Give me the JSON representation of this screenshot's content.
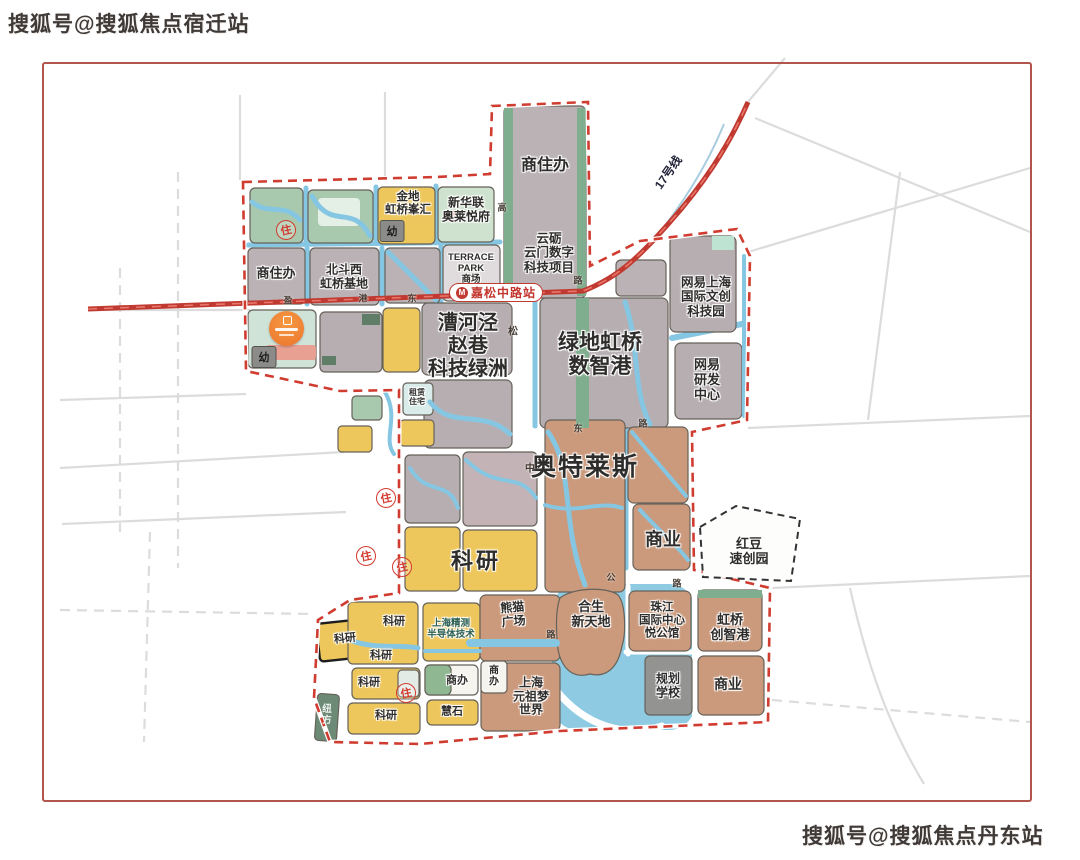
{
  "watermarks": {
    "top_left": "搜狐号@搜狐焦点宿迁站",
    "bottom_right": "搜狐号@搜狐焦点丹东站"
  },
  "metro": {
    "line_name": "17号线",
    "station_name": "嘉松中路站",
    "logo_letter": "M"
  },
  "stamps": {
    "residential": "住",
    "kindergarten": "幼"
  },
  "road_chars": {
    "c1": "盈",
    "c2": "港",
    "c3": "东",
    "c4": "路",
    "c5": "高",
    "c6": "松",
    "c7": "中",
    "c8": "东",
    "c9": "路",
    "c10": "公",
    "c11": "路",
    "c12": "路"
  },
  "colors": {
    "boundary_red": "#d03c30",
    "metro_red": "#c03a31",
    "water_blue": "#85c6e2",
    "parcel_grey": "#b7aeb2",
    "parcel_yellow": "#eec75c",
    "parcel_brown": "#cb9a7c"
  },
  "parcels": {
    "shangzhuban_north": "商住办",
    "yunli": "云砺\n云门数字\n科技项目",
    "jindi": "金地\n虹桥峯汇",
    "xinhualian": "新华联\n奥莱悦府",
    "shangzhuban_west": "商住办",
    "beidou": "北斗西\n虹桥基地",
    "terrace": "TERRACE\nPARK\n商场",
    "wangyi_park": "网易上海\n国际文创\n科技园",
    "wangyi_rd": "网易\n研发\n中心",
    "caohejing": "漕河泾\n赵巷\n科技绿洲",
    "lvdi": "绿地虹桥\n数智港",
    "zulin": "租赁\n住宅",
    "aotelaisi": "奥特莱斯",
    "shangye_east": "商业",
    "hongdou": "红豆\n速创园",
    "keyan_big": "科研",
    "keyan_1": "科研",
    "keyan_2": "科研",
    "keyan_3": "科研",
    "keyan_4": "科研",
    "keyan_5": "科研",
    "niufang": "纽\n方",
    "jingce": "上海精测\n半导体技术",
    "shangban_mid": "商办",
    "huishi": "慧石",
    "panda": "熊猫\n广场",
    "shangban_south": "商\n办",
    "yuanzu": "上海\n元祖梦\n世界",
    "hesheng": "合生\n新天地",
    "zhujiang": "珠江\n国际中心\n悦公馆",
    "hongqiao_czg": "虹桥\n创智港",
    "guihua": "规划\n学校",
    "shangye_south": "商业"
  }
}
